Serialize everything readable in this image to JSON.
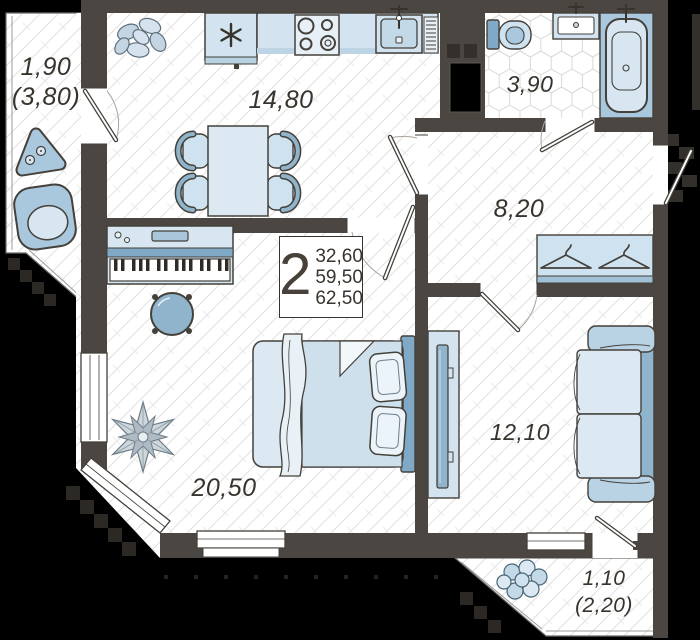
{
  "plan": {
    "rooms": [
      {
        "id": "balcony-top-left",
        "line1": "1,90",
        "line2": "(3,80)"
      },
      {
        "id": "kitchen",
        "area": "14,80"
      },
      {
        "id": "bathroom",
        "area": "3,90"
      },
      {
        "id": "hallway",
        "area": "8,20"
      },
      {
        "id": "living-room",
        "area": "20,50"
      },
      {
        "id": "bedroom",
        "area": "12,10"
      },
      {
        "id": "balcony-bottom-right",
        "line1": "1,10",
        "line2": "(2,20)"
      }
    ],
    "info_box": {
      "rooms_count": "2",
      "area1": "32,60",
      "area2": "59,50",
      "area3": "62,50"
    },
    "icons": [
      "freezer-asterisk",
      "faucet-cross",
      "hanger",
      "stove-burners"
    ],
    "colors": {
      "wall": "#4b4641",
      "outside": "#000000",
      "furniture_light": "#d3e4f0",
      "furniture_lighter": "#e7f0f6",
      "furniture_mid": "#a9c8de",
      "furniture_dark": "#7fa9c6",
      "floor_line": "#e2e2e2",
      "text": "#38332d"
    }
  }
}
